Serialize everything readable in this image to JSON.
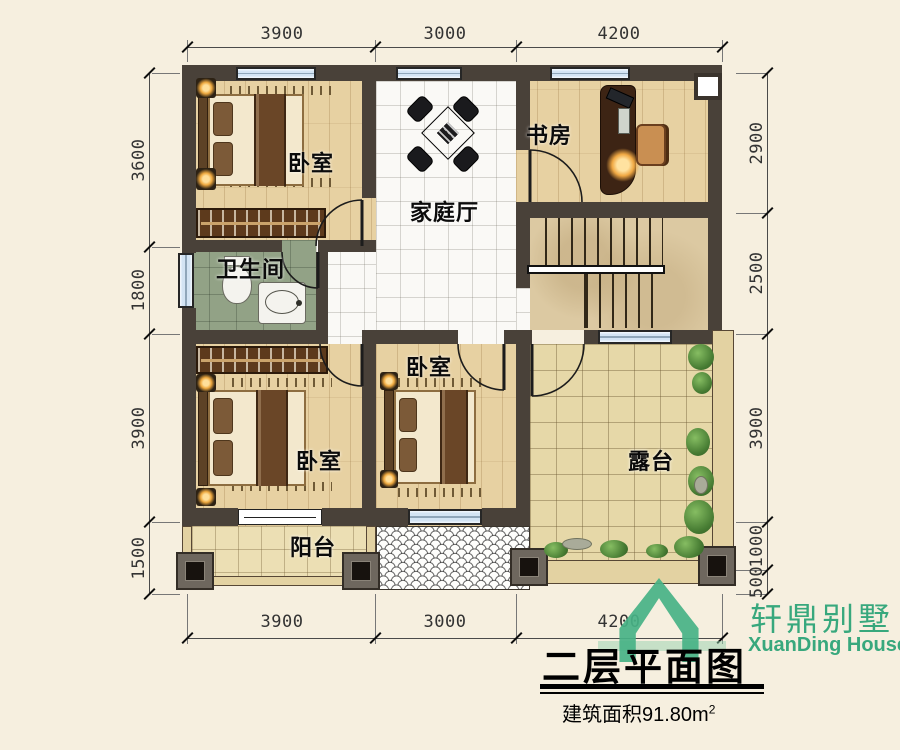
{
  "plan": {
    "rooms": {
      "bedroom1": "卧室",
      "bedroom2": "卧室",
      "bedroom3": "卧室",
      "study": "书房",
      "family_hall": "家庭厅",
      "bathroom": "卫生间",
      "terrace": "露台",
      "balcony": "阳台"
    },
    "dimensions": {
      "top": [
        "3900",
        "3000",
        "4200"
      ],
      "bottom": [
        "3900",
        "3000",
        "4200"
      ],
      "left": [
        "3600",
        "1800",
        "3900",
        "1500"
      ],
      "right": [
        "2900",
        "2500",
        "3900",
        "1000",
        "500"
      ]
    }
  },
  "title_block": {
    "brand_cn": "轩鼎别墅",
    "brand_en": "XuanDing House",
    "drawing_title": "二层平面图",
    "area_text": "建筑面积91.80m",
    "area_sup": "2",
    "logo_icon": "house-outline-icon"
  },
  "colors": {
    "brand_green": "#38a87d",
    "wall": "#494139",
    "window_blue": "#d3e4f4",
    "wood_floor": "#e7d1a2"
  }
}
